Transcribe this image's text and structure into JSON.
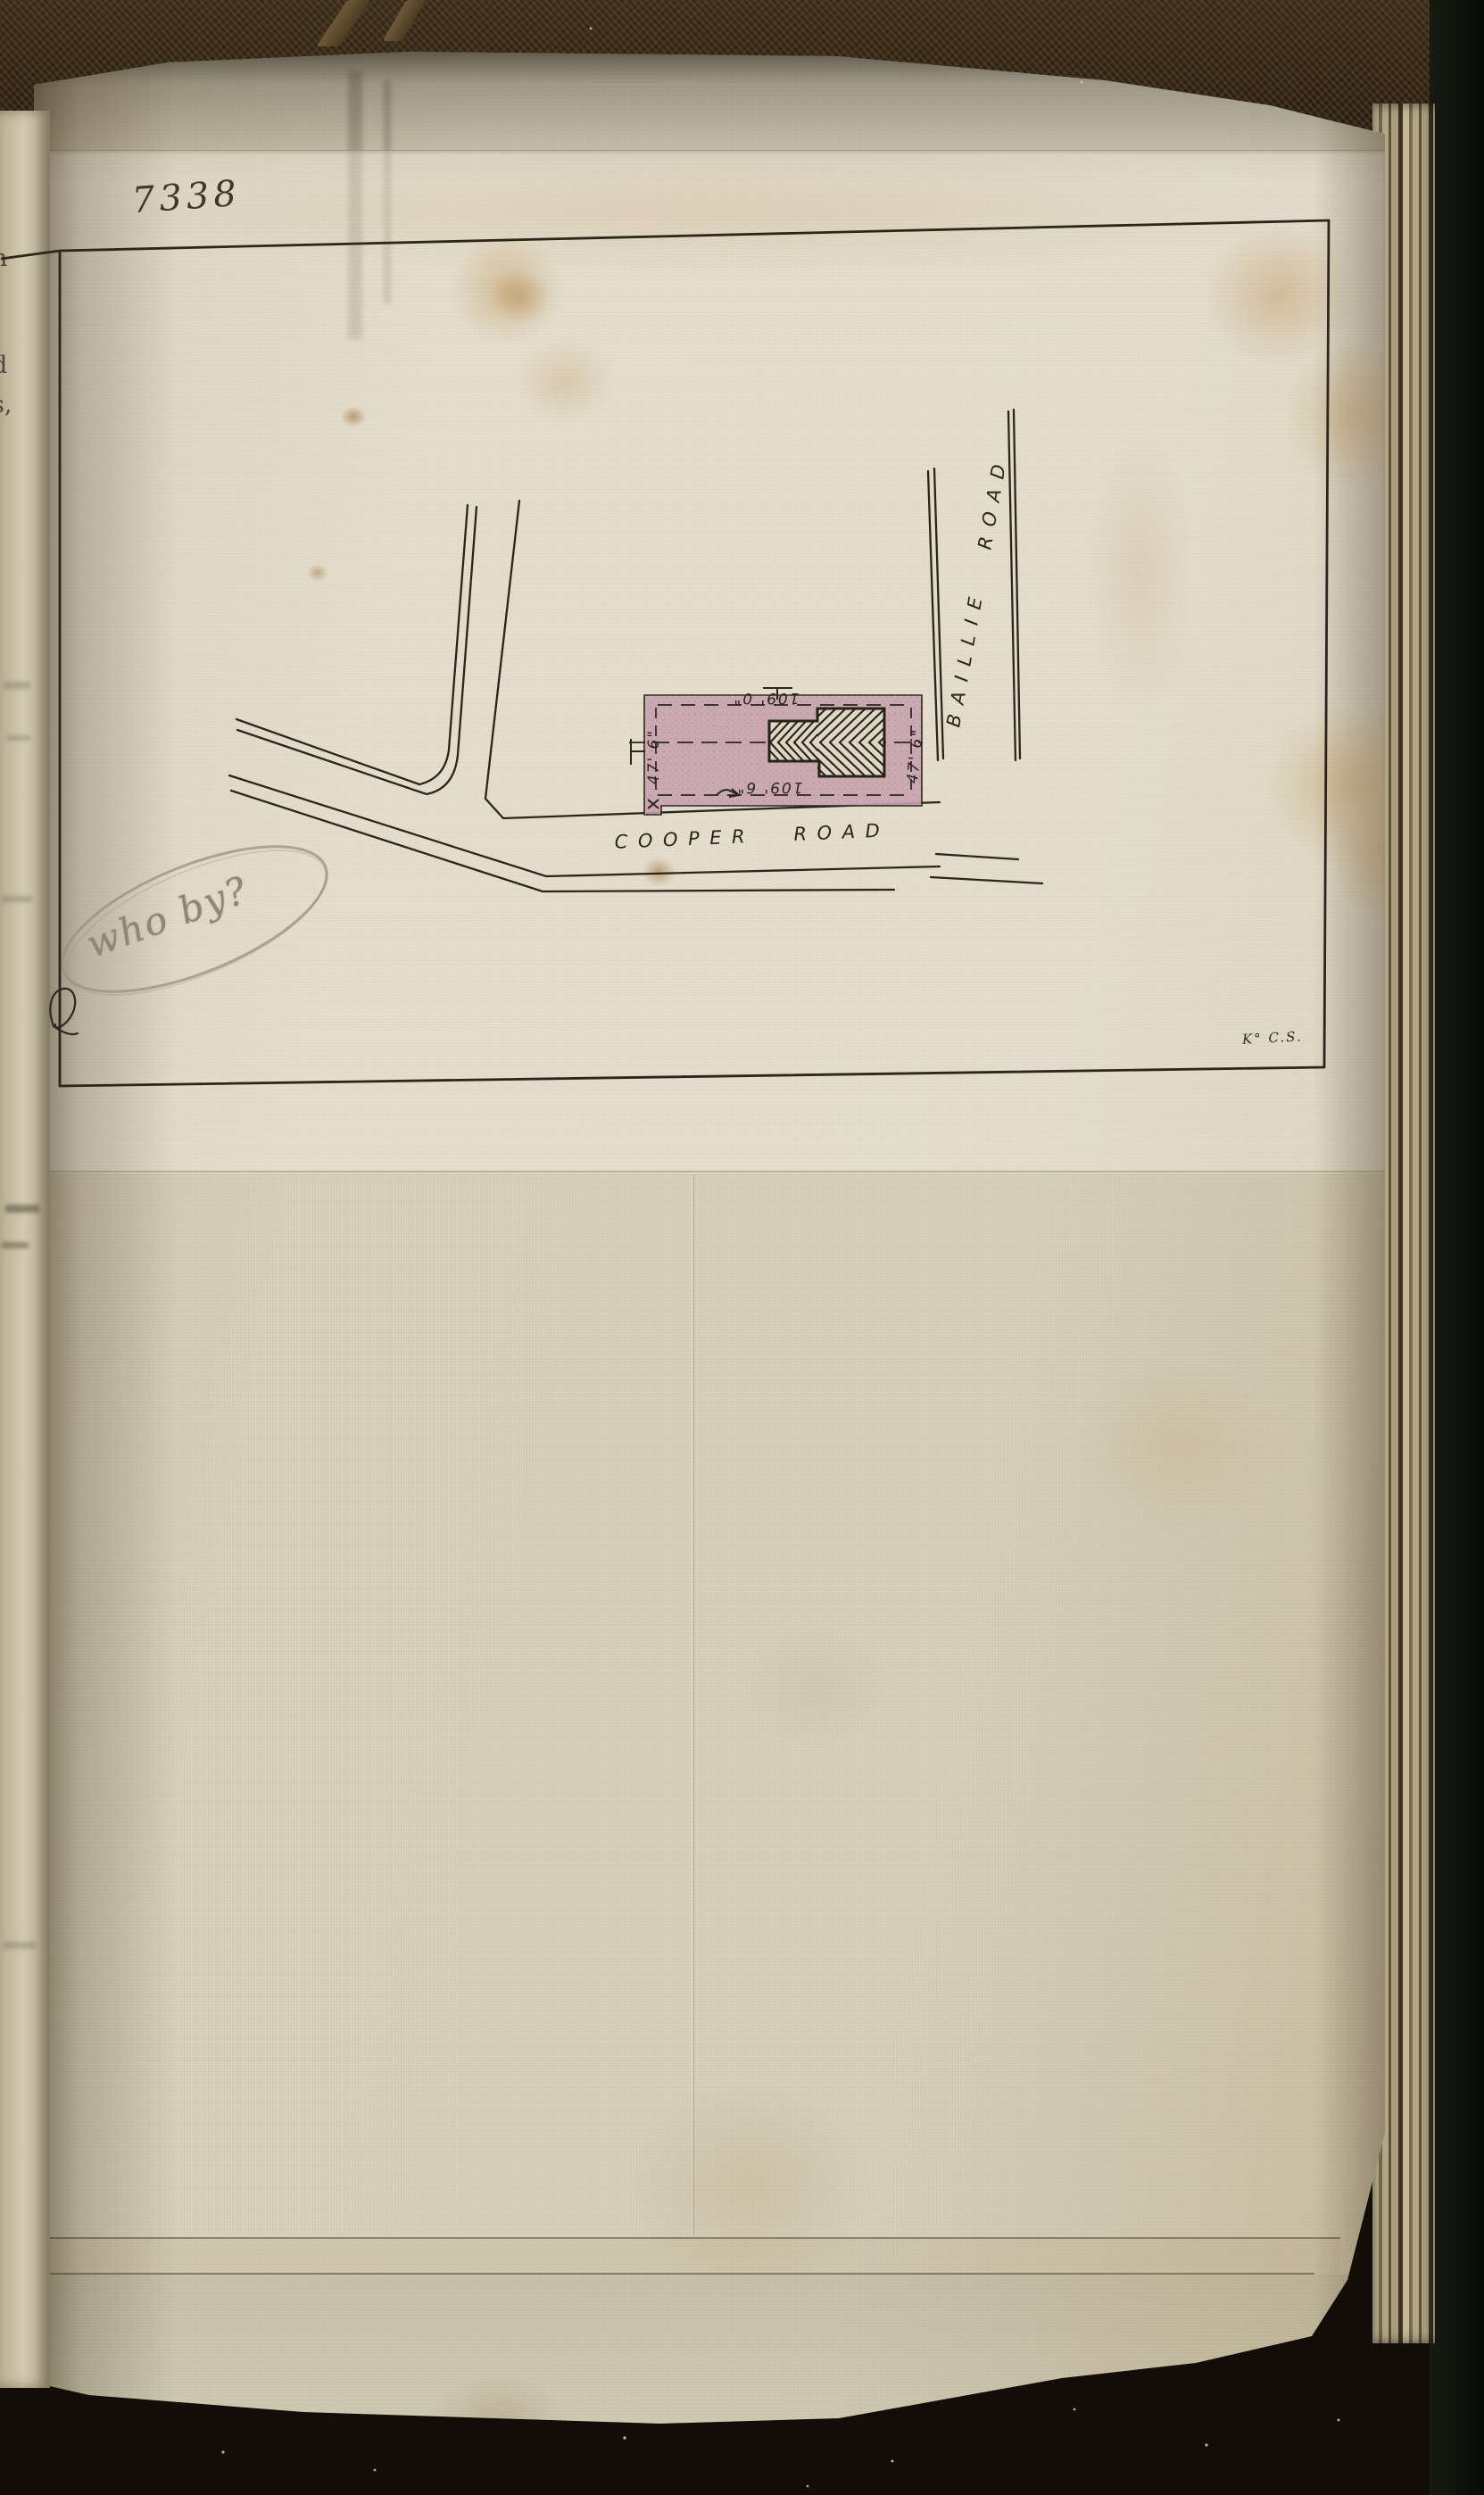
{
  "document": {
    "catalog_number": "7338",
    "corner_mark": "K° C.S.",
    "pencil_note": "who by?",
    "edge_fragments": [
      "n",
      ",",
      "d",
      "s,"
    ]
  },
  "plan": {
    "road_bottom": "COOPER ROAD",
    "road_right": "BAILLIE ROAD",
    "dim_top": "109' 0\"",
    "dim_bottom": "109' 6\"",
    "dim_left": "47' 6\"",
    "dim_right": "47' 6\"",
    "plot_fill": "#c6a3ae",
    "ink_color": "#2b251c",
    "pencil_color": "#8d8775"
  }
}
